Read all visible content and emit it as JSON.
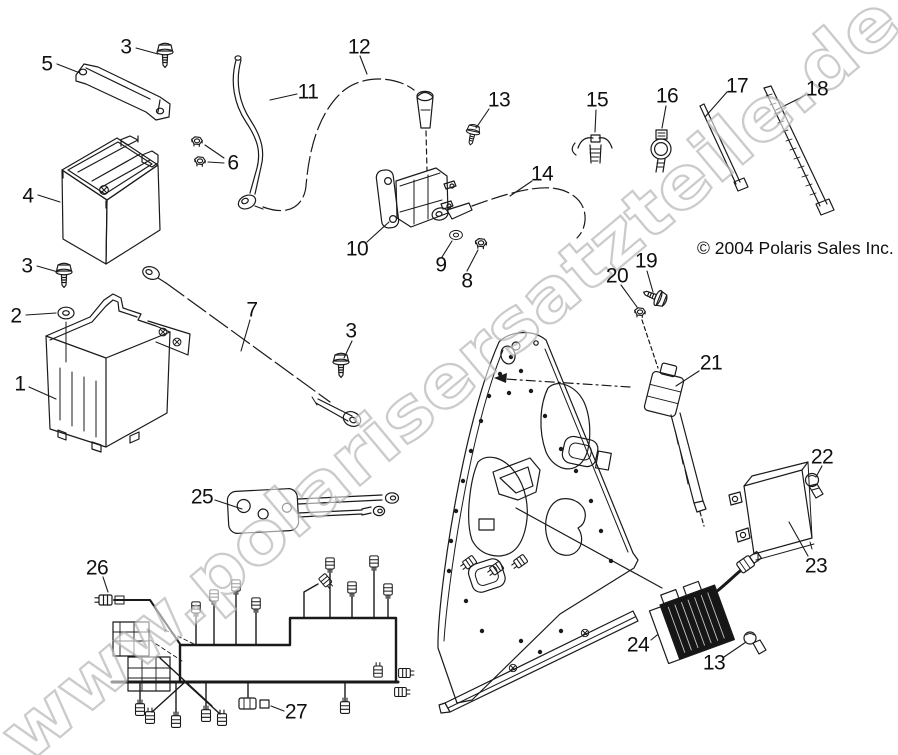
{
  "diagram": {
    "watermark": "www.polarisersatzteile.de",
    "copyright": "© 2004 Polaris Sales Inc.",
    "colors": {
      "line": "#1a1a1a",
      "background": "#ffffff",
      "watermark_stroke": "#a8a8a8"
    },
    "callouts": [
      {
        "label": "5",
        "x": 47,
        "y": 64
      },
      {
        "label": "3",
        "x": 126,
        "y": 47
      },
      {
        "label": "12",
        "x": 359,
        "y": 47
      },
      {
        "label": "11",
        "x": 308,
        "y": 92
      },
      {
        "label": "13",
        "x": 499,
        "y": 100
      },
      {
        "label": "15",
        "x": 597,
        "y": 100
      },
      {
        "label": "16",
        "x": 667,
        "y": 96
      },
      {
        "label": "17",
        "x": 737,
        "y": 86
      },
      {
        "label": "18",
        "x": 817,
        "y": 89
      },
      {
        "label": "6",
        "x": 233,
        "y": 163
      },
      {
        "label": "4",
        "x": 28,
        "y": 196
      },
      {
        "label": "14",
        "x": 542,
        "y": 174
      },
      {
        "label": "10",
        "x": 357,
        "y": 249
      },
      {
        "label": "9",
        "x": 441,
        "y": 265
      },
      {
        "label": "8",
        "x": 467,
        "y": 281
      },
      {
        "label": "19",
        "x": 646,
        "y": 261
      },
      {
        "label": "20",
        "x": 617,
        "y": 276
      },
      {
        "label": "3",
        "x": 27,
        "y": 266
      },
      {
        "label": "2",
        "x": 16,
        "y": 316
      },
      {
        "label": "7",
        "x": 252,
        "y": 310
      },
      {
        "label": "3",
        "x": 351,
        "y": 331
      },
      {
        "label": "1",
        "x": 20,
        "y": 384
      },
      {
        "label": "21",
        "x": 711,
        "y": 363
      },
      {
        "label": "22",
        "x": 822,
        "y": 457
      },
      {
        "label": "25",
        "x": 202,
        "y": 497
      },
      {
        "label": "23",
        "x": 816,
        "y": 566
      },
      {
        "label": "26",
        "x": 97,
        "y": 568
      },
      {
        "label": "24",
        "x": 638,
        "y": 645
      },
      {
        "label": "13",
        "x": 714,
        "y": 663
      },
      {
        "label": "27",
        "x": 296,
        "y": 712
      }
    ]
  }
}
